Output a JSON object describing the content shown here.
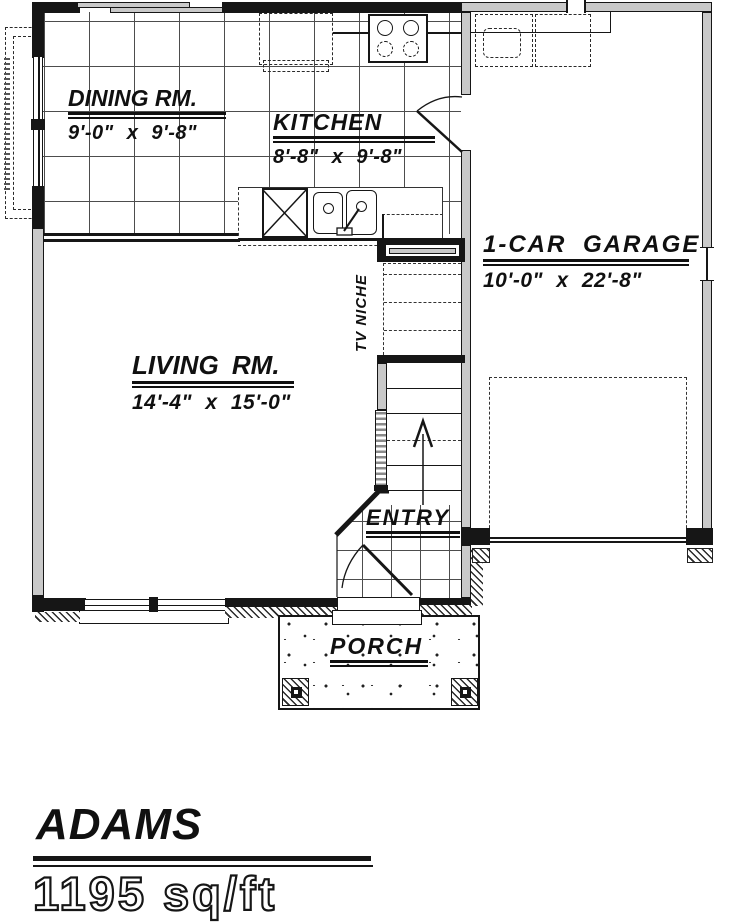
{
  "plan": {
    "rooms": {
      "dining": {
        "name": "DINING RM.",
        "dims": "9'-0\" x 9'-8\""
      },
      "kitchen": {
        "name": "KITCHEN",
        "dims": "8'-8\" x 9'-8\""
      },
      "garage": {
        "name": "1-CAR GARAGE",
        "dims": "10'-0\" x 22'-8\""
      },
      "living": {
        "name": "LIVING RM.",
        "dims": "14'-4\" x 15'-0\""
      }
    },
    "areas": {
      "tv_niche": "TV NICHE",
      "entry": "ENTRY",
      "porch": "PORCH"
    },
    "fixtures": [
      "refrigerator-icon",
      "stove-icon",
      "dishwasher-icon",
      "double-sink-icon",
      "stairs-up-arrow-icon",
      "car-space-outline",
      "washer-dryer-outline",
      "sliding-door-icon",
      "entry-door-icon",
      "garage-door"
    ]
  },
  "title": {
    "name": "ADAMS",
    "area": "1195 sq/ft"
  },
  "colors": {
    "line": "#161616",
    "wall_fill": "#c9c9c9",
    "paper": "#ffffff"
  }
}
